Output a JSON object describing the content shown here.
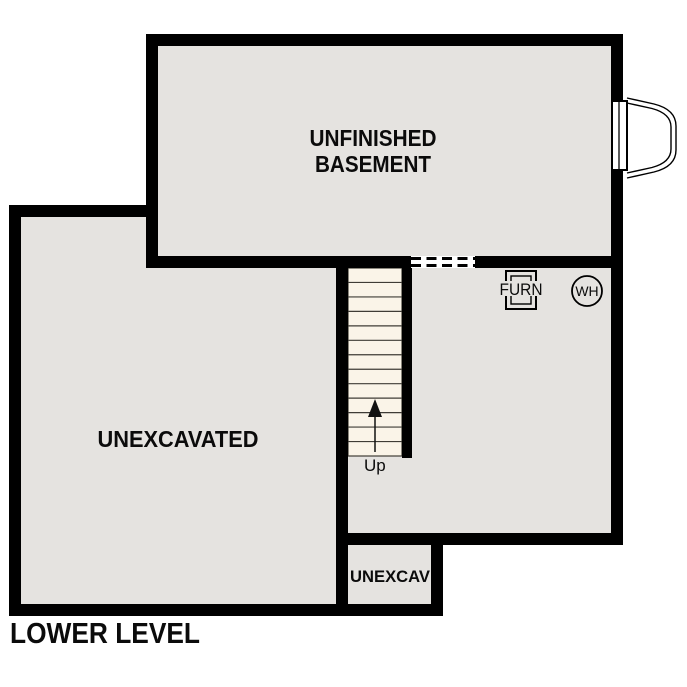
{
  "plan": {
    "title": "LOWER LEVEL"
  },
  "rooms": {
    "basement": {
      "name_line1": "UNFINISHED",
      "name_line2": "BASEMENT"
    },
    "unexcavated": {
      "name": "UNEXCAVATED"
    },
    "unexcav_small": {
      "name": "UNEXCAV"
    }
  },
  "stairs": {
    "label": "Up",
    "tread_count": 13,
    "direction": "up"
  },
  "equipment": {
    "furnace": "FURN",
    "water_heater": "WH"
  },
  "colors": {
    "wall": "#000000",
    "floor": "#e5e3e0",
    "stair_tread": "#faf4e8",
    "tread_line": "#3f3c36",
    "background": "#ffffff",
    "label_text": "#0b0b0b"
  }
}
